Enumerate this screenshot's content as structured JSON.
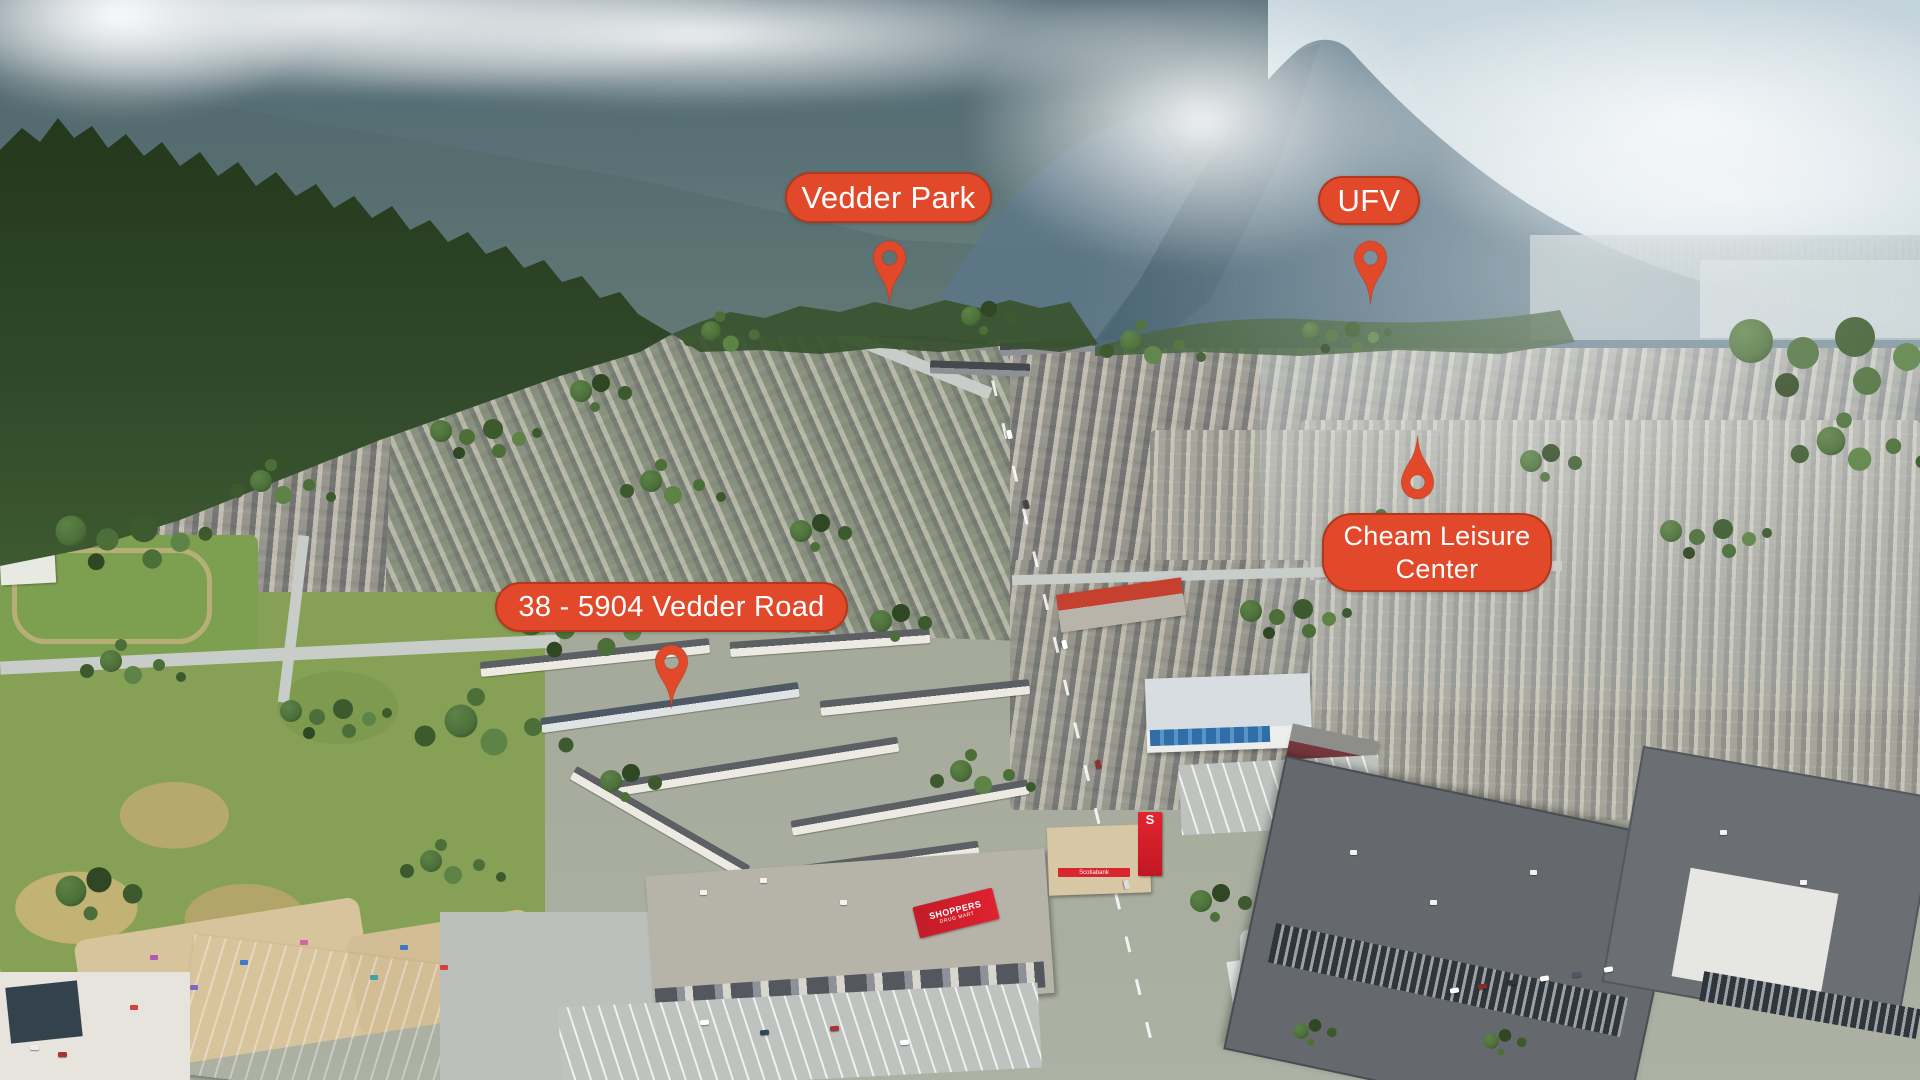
{
  "scene": {
    "description": "Aerial drone photograph of a valley town with forested mountains behind; four orange map-pin annotations mark locations."
  },
  "annotations": {
    "vedder_park": {
      "label": "Vedder Park"
    },
    "ufv": {
      "label": "UFV"
    },
    "cheam_leisure_center": {
      "label": "Cheam Leisure Center"
    },
    "property": {
      "label": "38 - 5904 Vedder Road"
    }
  },
  "signage": {
    "shoppers_name": "SHOPPERS",
    "shoppers_sub": "DRUG MART",
    "scotiabank_logo": "S",
    "scotiabank_name": "Scotiabank"
  },
  "colors": {
    "marker": "#E2492B",
    "marker_border": "#A23418",
    "marker_text": "#FFFFFF",
    "shoppers_red": "#D91F2C",
    "scotiabank_red": "#DF1F2D",
    "glass_blue": "#3C7FB5"
  }
}
